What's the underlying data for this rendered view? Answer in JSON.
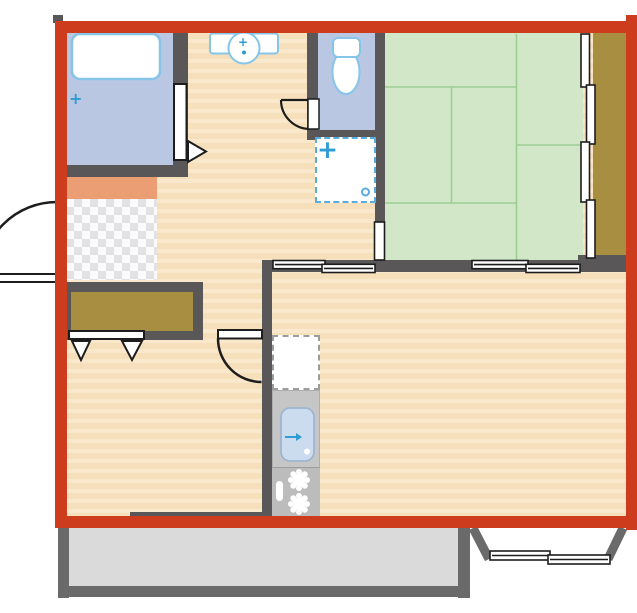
{
  "colors": {
    "page_bg": "#ffffff",
    "highlight_red": "#ce3c1e",
    "wall_dark": "#595757",
    "wall_gray": "#6a6a6a",
    "floor_wood": "#f6dfbb",
    "floor_wood_stripe": "#fae8cc",
    "floor_wet_blue": "#bac7e3",
    "fixture_outline_blue": "#84c5e8",
    "accent_blue": "#2f9cd3",
    "dashed_blue": "#58ade0",
    "tatami_green": "#d1e7c7",
    "tatami_line_green": "#9ccd93",
    "wood_brown": "#a88e40",
    "entry_salmon": "#eb9e74",
    "checker_gray": "#e2e2e5",
    "balcony_gray": "#dadada",
    "counter_gray": "#c6c6c6",
    "stove_gray": "#bcbcbc",
    "sink_blue": "#cadcee",
    "sink_border": "#9fb5d0",
    "line_ink": "#1d1d1d"
  },
  "icons": {
    "bath_sparkle": "+",
    "washer_plus": "+",
    "vanity_faucet": "+"
  }
}
